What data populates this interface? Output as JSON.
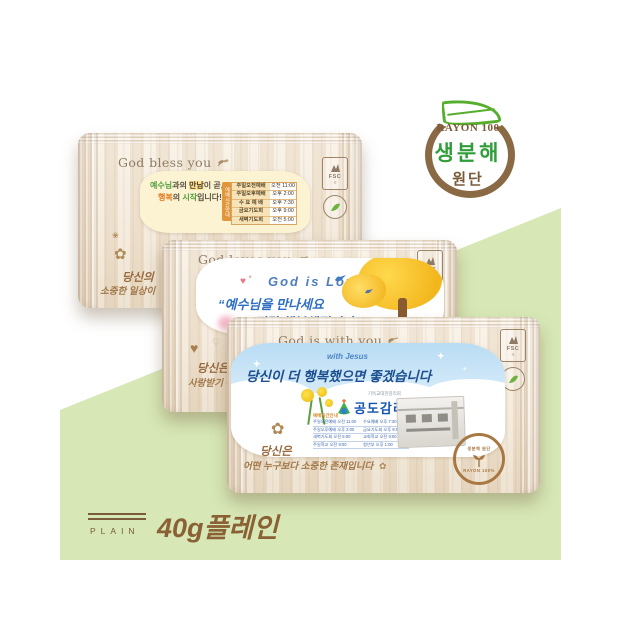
{
  "background": {
    "panel_color": "#d7e7b6"
  },
  "badge": {
    "material": "RAYON 100",
    "biodegradable": "생분해",
    "fabric": "원단"
  },
  "fsc_label": "FSC",
  "stamp": {
    "arc_top": "생분해 원단",
    "arc_bottom": "RAYON 100%"
  },
  "product": {
    "plain_label": "PLAIN",
    "weight_label": "40g플레인"
  },
  "packages": {
    "top": {
      "header": "God bless you",
      "sticker": {
        "m1a": "예수님",
        "m1b": "과의 ",
        "m1c": "만남",
        "m1d": "이 곧,",
        "m2a": "행복",
        "m2b": "의 ",
        "m2c": "시작",
        "m2d": "입니다!",
        "tab": "예배시간안내",
        "schedule": [
          {
            "name": "주일오전예배",
            "time": "오전 11:00"
          },
          {
            "name": "주일오후예배",
            "time": "오후 2:00"
          },
          {
            "name": "수 요 예 배",
            "time": "오후 7:30"
          },
          {
            "name": "금요기도회",
            "time": "오후 9:00"
          },
          {
            "name": "새벽기도회",
            "time": "오전 5:00"
          }
        ]
      },
      "footer": {
        "line1": "당신의",
        "line2": "소중한 일상이"
      }
    },
    "middle": {
      "header": "God loves you",
      "sticker": {
        "title": "God is Love",
        "line1": "“예수님을 만나세요",
        "line2": "정말 행복해집니다”"
      },
      "footer": {
        "line1": "당신은",
        "line2": "사랑받기 위"
      }
    },
    "bottom": {
      "header": "God is with you",
      "sticker": {
        "small": "with Jesus",
        "message": "당신이 더 행복했으면 좋겠습니다",
        "church_org": "기독교대한감리회",
        "church_name": "공도감리교회",
        "mini_title": "예배시간안내",
        "mini_schedule": [
          {
            "l": "주일오전예배 오전 11:00",
            "r": "수요예배 오후 7:30"
          },
          {
            "l": "주일오후예배 오후 2:00",
            "r": "금요기도회 오후 9:00"
          },
          {
            "l": "새벽기도회 오전 5:00",
            "r": "교회학교 오전 9:00"
          },
          {
            "l": "주일학교 오전 9:00",
            "r": "청년부 오후 1:00"
          }
        ]
      },
      "footer": {
        "line1": "당신은",
        "line2": "어떤 누구보다 소중한 존재입니다"
      }
    }
  }
}
